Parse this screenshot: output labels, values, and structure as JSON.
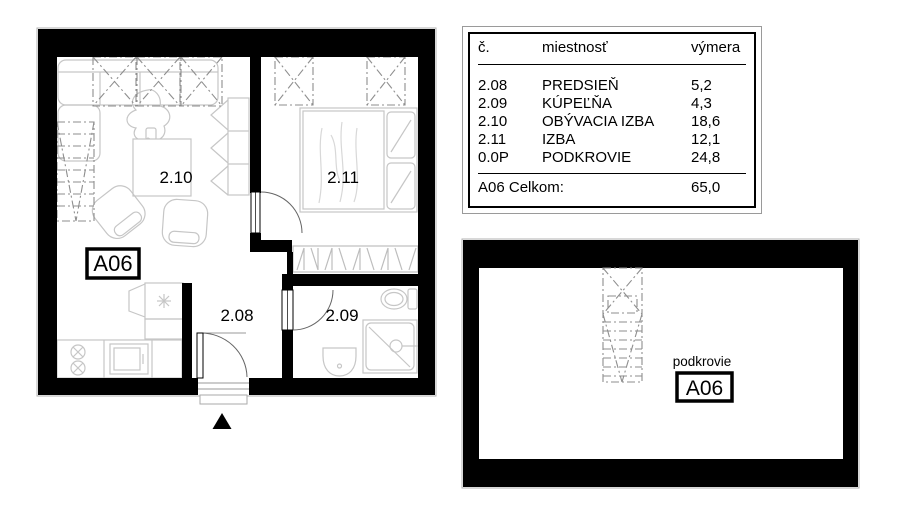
{
  "legend_table": {
    "columns": {
      "no": "č.",
      "room": "miestnosť",
      "area": "výmera"
    },
    "rows": [
      {
        "no": "2.08",
        "room": "PREDSIEŇ",
        "area": "5,2"
      },
      {
        "no": "2.09",
        "room": "KÚPEĽŇA",
        "area": "4,3"
      },
      {
        "no": "2.10",
        "room": "OBÝVACIA IZBA",
        "area": "18,6"
      },
      {
        "no": "2.11",
        "room": "IZBA",
        "area": "12,1"
      },
      {
        "no": "0.0P",
        "room": "PODKROVIE",
        "area": "24,8"
      }
    ],
    "total": {
      "label": "A06 Celkom:",
      "value": "65,0"
    }
  },
  "floor_plan": {
    "unit_label": "A06",
    "room_labels": {
      "hall": "2.08",
      "bathroom": "2.09",
      "living_room": "2.10",
      "bedroom": "2.11"
    }
  },
  "attic_plan": {
    "title": "podkrovie",
    "unit_label": "A06"
  },
  "colors": {
    "wall": "#000000",
    "furniture": "#c6c6c6",
    "hidden_line": "#8e8e8e",
    "background": "#ffffff"
  }
}
